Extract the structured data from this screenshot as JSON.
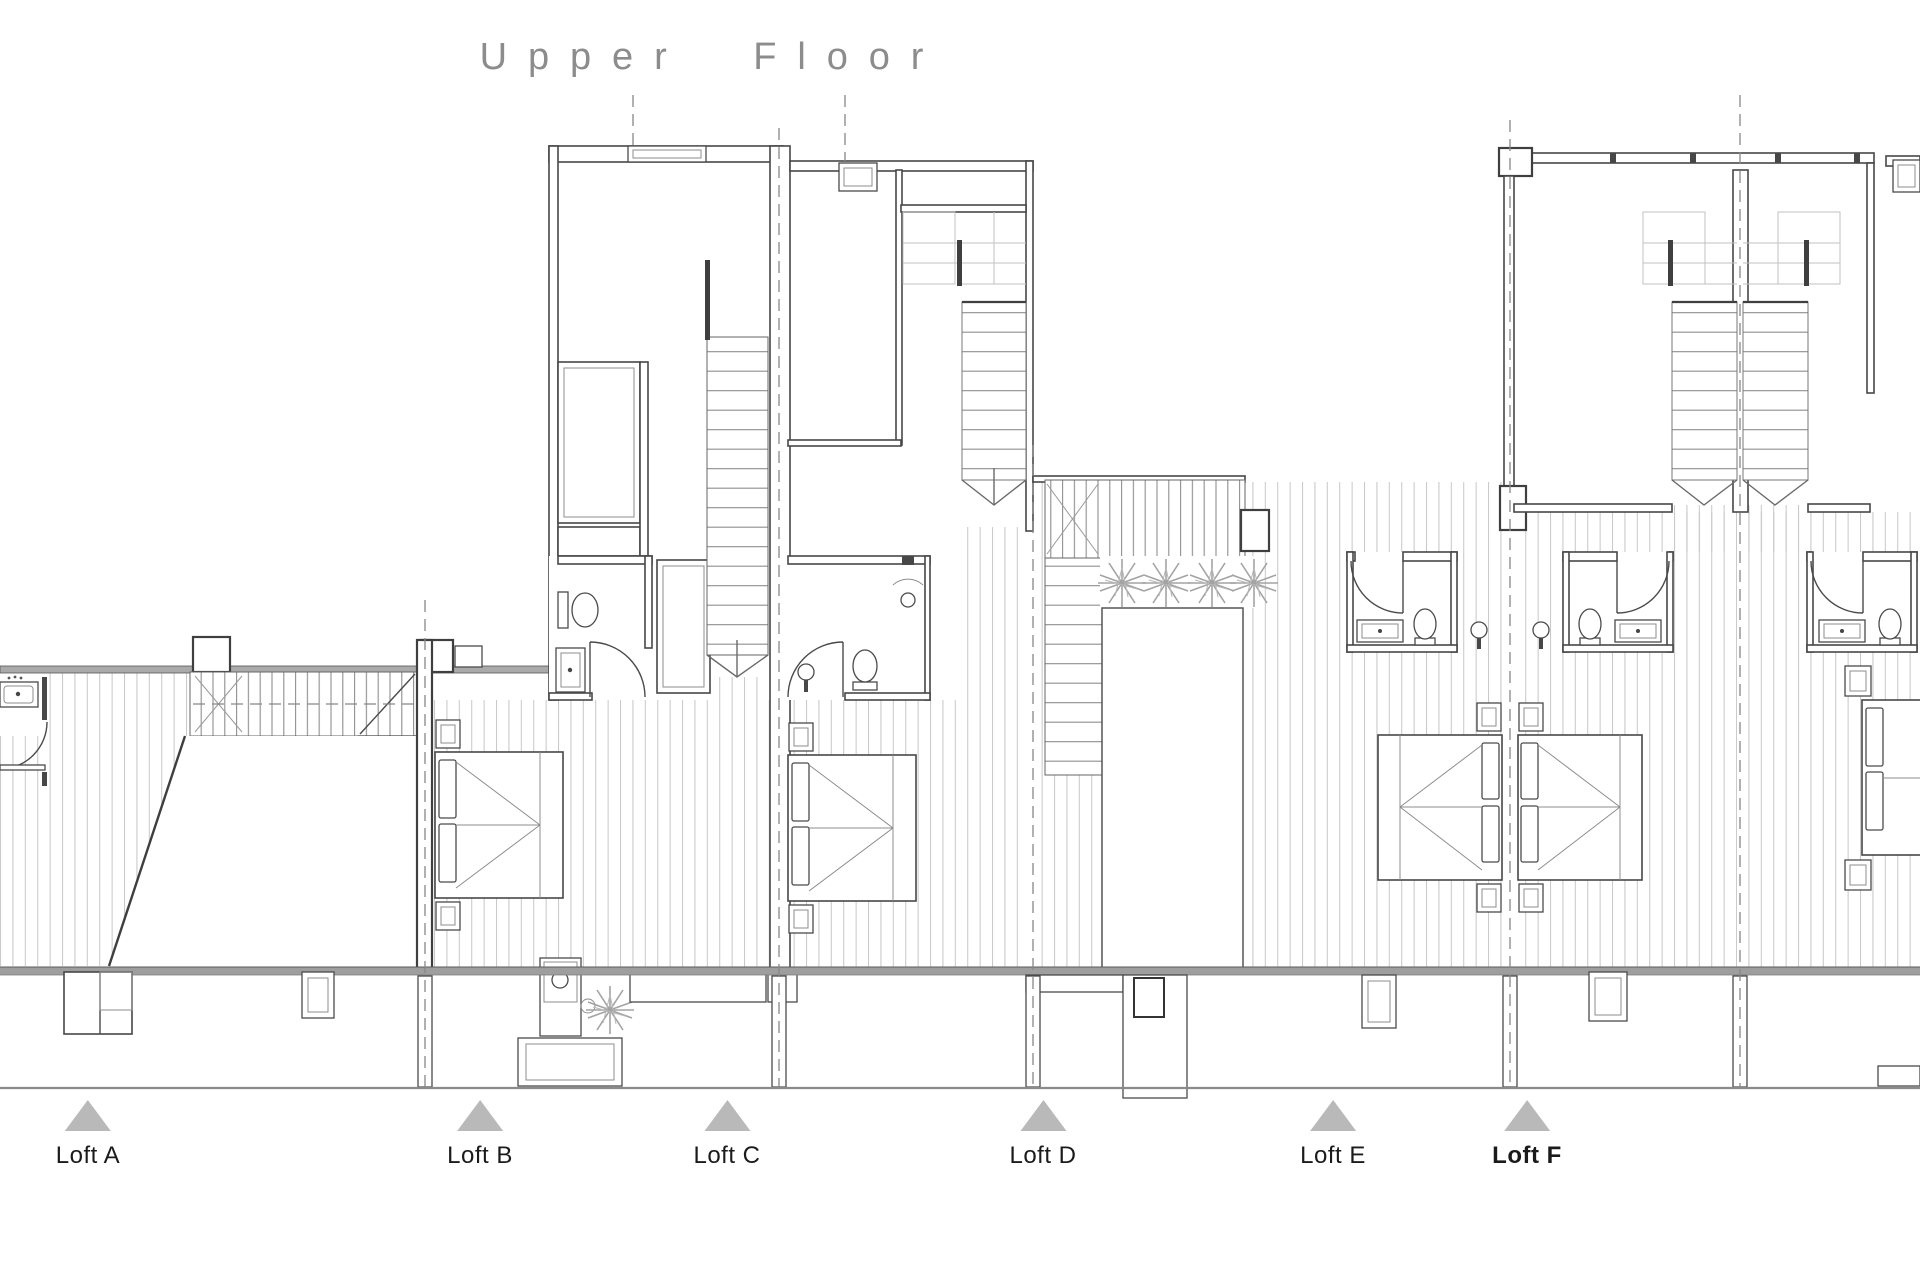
{
  "title": "Upper Floor",
  "floor_plan": {
    "lofts": [
      {
        "id": "a",
        "label": "Loft A",
        "emphasis": false
      },
      {
        "id": "b",
        "label": "Loft B",
        "emphasis": false
      },
      {
        "id": "c",
        "label": "Loft C",
        "emphasis": false
      },
      {
        "id": "d",
        "label": "Loft D",
        "emphasis": false
      },
      {
        "id": "e",
        "label": "Loft E",
        "emphasis": false
      },
      {
        "id": "f",
        "label": "Loft F",
        "emphasis": true
      }
    ],
    "marker_icon": "triangle-up-icon",
    "drawing_icons": [
      "bed-icon",
      "toilet-icon",
      "sink-icon",
      "shower-icon",
      "plant-icon",
      "stair-icon",
      "door-swing-icon",
      "deck-hatch",
      "void-opening",
      "party-wall-centerline"
    ]
  },
  "colors": {
    "background": "#ffffff",
    "title_text": "#8c8c8c",
    "label_text": "#1b1b1b",
    "marker_fill": "#b9b9b9",
    "wall_line": "#474747",
    "light_line": "#9a9a9a",
    "hatch_line": "#c9c9c9",
    "ground_line": "#8a8a8a"
  }
}
